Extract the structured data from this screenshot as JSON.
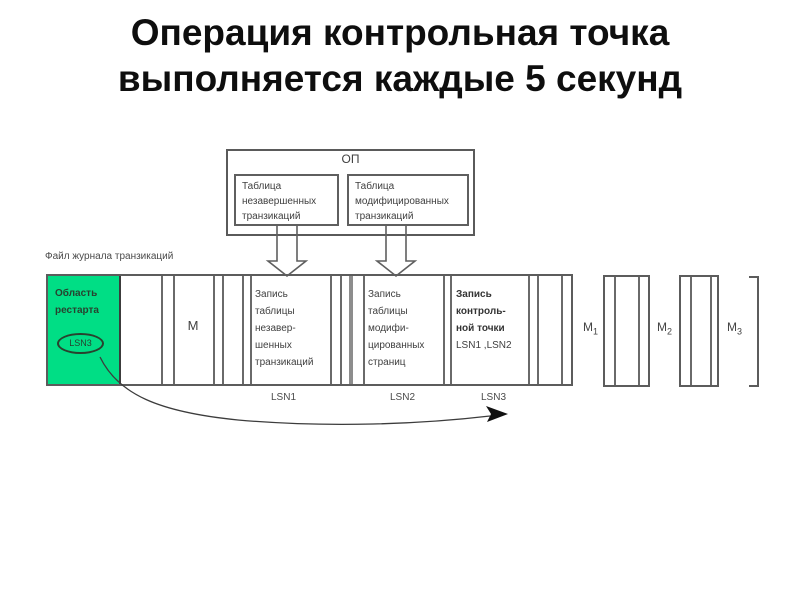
{
  "title": {
    "line1": "Операция контрольная точка",
    "line2": "выполняется каждые 5 секунд"
  },
  "memory": {
    "label": "ОП",
    "table1": {
      "l1": "Таблица",
      "l2": "незавершенных",
      "l3": "транзикаций"
    },
    "table2": {
      "l1": "Таблица",
      "l2": "модифицированных",
      "l3": "транзикаций"
    }
  },
  "log": {
    "file_label": "Файл журнала транзикаций",
    "restart": {
      "l1": "Область",
      "l2": "рестарта",
      "lsn": "LSN3"
    },
    "m_label": "М",
    "rec1": {
      "l1": "Запись",
      "l2": "таблицы",
      "l3": "незавер-",
      "l4": "шенных",
      "l5": "транзикаций",
      "lsn": "LSN1"
    },
    "rec2": {
      "l1": "Запись",
      "l2": "таблицы",
      "l3": "модифи-",
      "l4": "цированных",
      "l5": "страниц",
      "lsn": "LSN2"
    },
    "rec3": {
      "l1": "Запись",
      "l2": "контроль-",
      "l3": "ной точки",
      "l4": "LSN1 ,LSN2",
      "lsn": "LSN3"
    },
    "mirrors": {
      "m1": {
        "base": "М",
        "sub": "1"
      },
      "m2": {
        "base": "М",
        "sub": "2"
      },
      "m3": {
        "base": "М",
        "sub": "3"
      }
    }
  },
  "colors": {
    "restart_green": "#00DE85",
    "diagram_line_gray": "#5c5c5c",
    "diagram_text_gray": "#3f3f3f"
  }
}
